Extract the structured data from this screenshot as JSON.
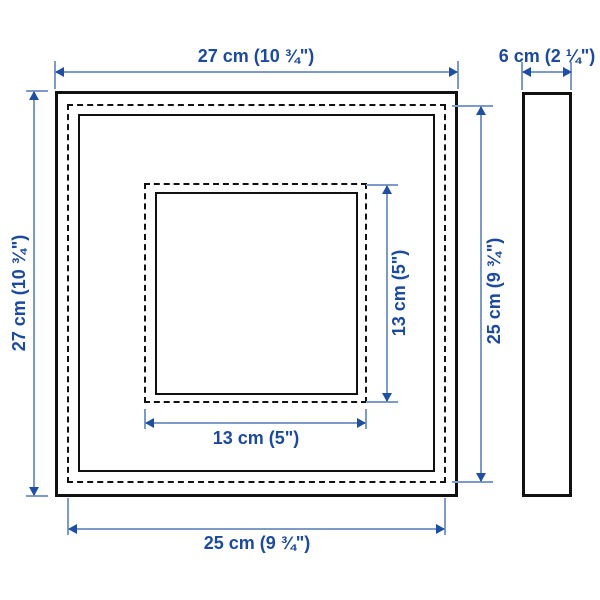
{
  "diagram": {
    "name": "square picture frame dimension drawing",
    "views": {
      "front": "front view with dashed back-panel outline and picture opening",
      "side": "side profile view"
    },
    "dimensions": {
      "outer_width": "27 cm (10 ¾\")",
      "outer_height": "27 cm (10 ¾\")",
      "depth": "6 cm (2 ¼\")",
      "back_height": "25 cm (9 ¾\")",
      "back_width": "25 cm (9 ¾\")",
      "picture_height": "13 cm (5\")",
      "picture_width": "13 cm (5\")"
    },
    "colors": {
      "outline": "#111111",
      "dimension_line": "#7d9bc8",
      "dimension_arrow": "#1f4fa4",
      "dimension_text": "#1c4a9f",
      "background": "#ffffff"
    }
  }
}
